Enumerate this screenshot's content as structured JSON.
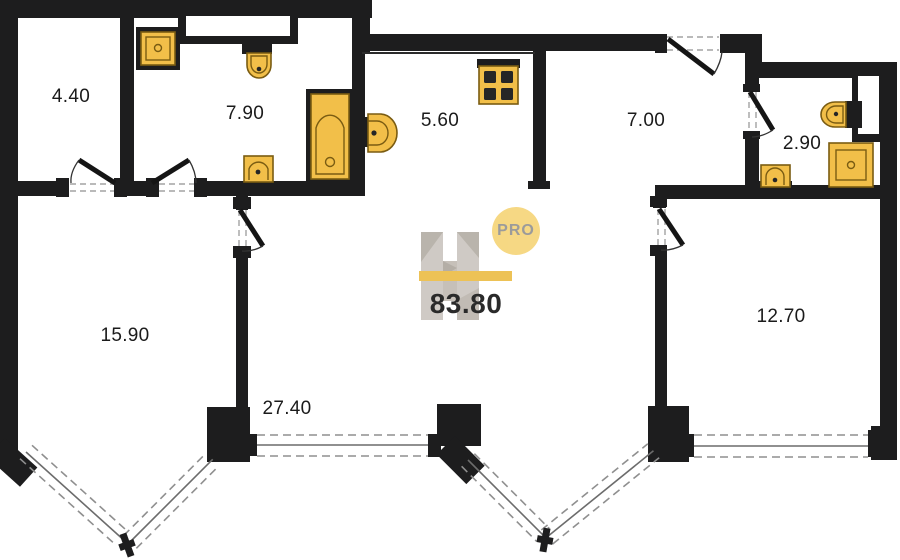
{
  "watermark": {
    "logo_letter": "H",
    "badge": "PRO",
    "total_area": "83.80"
  },
  "rooms": [
    {
      "area": "4.40"
    },
    {
      "area": "7.90"
    },
    {
      "area": "5.60"
    },
    {
      "area": "7.00"
    },
    {
      "area": "2.90"
    },
    {
      "area": "15.90"
    },
    {
      "area": "27.40"
    },
    {
      "area": "12.70"
    }
  ],
  "fixtures": [
    {
      "icon": "shower-tray-icon"
    },
    {
      "icon": "wall-toilet-icon"
    },
    {
      "icon": "bathtub-icon"
    },
    {
      "icon": "wash-basin-icon"
    },
    {
      "icon": "cooktop-icon"
    },
    {
      "icon": "wash-basin-icon"
    },
    {
      "icon": "wall-toilet-icon"
    },
    {
      "icon": "shower-tray-icon"
    },
    {
      "icon": "wash-basin-icon"
    }
  ],
  "colors": {
    "wall": "#1d1d1e",
    "fixture_fill": "#f2bf49",
    "fixture_outline": "#7a5c12",
    "logo_bar_yellow": "#edbf4e",
    "logo_badge_yellow": "#f6d67d",
    "logo_gray": "#cdc8c2",
    "label_text": "#1b1b1b",
    "window_line": "#8f8f8f",
    "background": "#ffffff"
  }
}
